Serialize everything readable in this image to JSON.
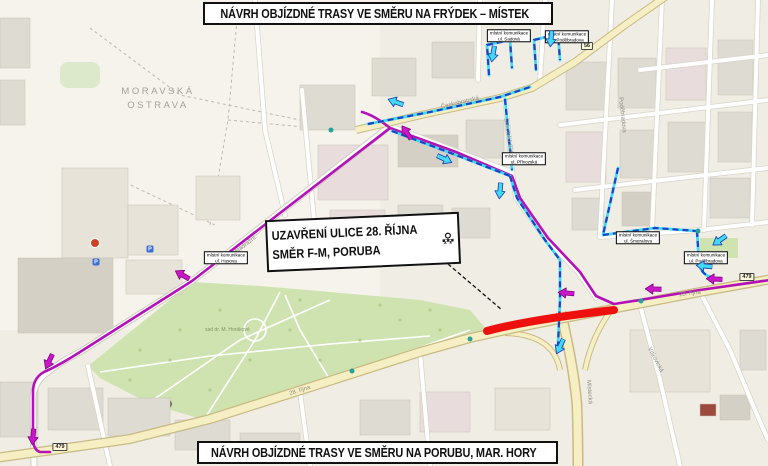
{
  "banners": {
    "top": {
      "text": "NÁVRH OBJÍZDNÉ TRASY VE SMĚRU NA FRÝDEK – MÍSTEK",
      "arrow_icon": "arrow-right-icon",
      "arrow_color": "#41d9f6"
    },
    "bottom": {
      "text": "NÁVRH OBJÍZDNÉ TRASY VE SMĚRU NA PORUBU, MAR. HORY",
      "arrow_icon": "arrow-right-icon",
      "arrow_color": "#cb16cb"
    }
  },
  "closure_callout": {
    "line1": "UZAVŘENÍ ULICE 28. ŘÍJNA",
    "line2": "SMĚR F-M, PORUBA",
    "icon": "road-closure-icon"
  },
  "colors": {
    "closure_red": "#ee100f",
    "detour_frydek_fill": "#41d9f6",
    "detour_frydek_dash": "#1d42c4",
    "detour_poruba": "#b312b6",
    "park_green": "#cfe3b0",
    "arrow_cyan": "#41d9f6",
    "arrow_cyan_edge": "#1b3fae",
    "arrow_magenta": "#cb16cb",
    "arrow_magenta_edge": "#7c0a7c"
  },
  "map": {
    "district_label_line1": "MORAVSKÁ",
    "district_label_line2": "OSTRAVA",
    "park_label": "sad dr. M. Horákové",
    "street_labels": [
      {
        "text": "Českobratrská",
        "x": 460,
        "y": 103,
        "rot": -13
      },
      {
        "text": "28. října",
        "x": 300,
        "y": 391,
        "rot": -18
      },
      {
        "text": "28. října",
        "x": 690,
        "y": 294,
        "rot": -7
      },
      {
        "text": "Nádražní",
        "x": 246,
        "y": 245,
        "rot": -38
      },
      {
        "text": "Místecká",
        "x": 589,
        "y": 392,
        "rot": 86
      },
      {
        "text": "Sokolská třída",
        "x": 508,
        "y": 137,
        "rot": 82
      },
      {
        "text": "Poděbradova",
        "x": 622,
        "y": 115,
        "rot": 84
      },
      {
        "text": "Vítkovická",
        "x": 655,
        "y": 360,
        "rot": 62
      }
    ],
    "road_badges": [
      {
        "text": "479",
        "x": 60,
        "y": 447
      },
      {
        "text": "479",
        "x": 747,
        "y": 277
      },
      {
        "text": "56",
        "x": 587,
        "y": 46
      }
    ],
    "local_road_labels": [
      {
        "line1": "místní komunikace",
        "line2": "ul. Sadová",
        "x": 509,
        "y": 36
      },
      {
        "line1": "místní komunikace",
        "line2": "ul. Poděbradova",
        "x": 567,
        "y": 37
      },
      {
        "line1": "místní komunikace",
        "line2": "ul. Přívozská",
        "x": 524,
        "y": 159
      },
      {
        "line1": "místní komunikace",
        "line2": "ul. Šmeralova",
        "x": 638,
        "y": 238
      },
      {
        "line1": "místní komunikace",
        "line2": "ul. Poděbradova",
        "x": 706,
        "y": 258
      },
      {
        "line1": "místní komunikace",
        "line2": "ul. Husova",
        "x": 226,
        "y": 258
      }
    ],
    "poi": [
      {
        "type": "parking",
        "x": 150,
        "y": 249
      },
      {
        "type": "parking",
        "x": 96,
        "y": 262
      },
      {
        "type": "stop",
        "x": 352,
        "y": 371
      },
      {
        "type": "stop",
        "x": 470,
        "y": 339
      },
      {
        "type": "stop",
        "x": 641,
        "y": 301
      },
      {
        "type": "stop",
        "x": 331,
        "y": 130
      },
      {
        "type": "stop",
        "x": 698,
        "y": 231
      },
      {
        "type": "red",
        "x": 95,
        "y": 243
      }
    ]
  },
  "route_arrows": [
    {
      "color": "cyan",
      "x": 396,
      "y": 100,
      "rot": 200
    },
    {
      "color": "cyan",
      "x": 444,
      "y": 161,
      "rot": 25
    },
    {
      "color": "cyan",
      "x": 498,
      "y": 191,
      "rot": 95
    },
    {
      "color": "cyan",
      "x": 491,
      "y": 54,
      "rot": 100
    },
    {
      "color": "cyan",
      "x": 549,
      "y": 39,
      "rot": 95
    },
    {
      "color": "cyan",
      "x": 718,
      "y": 239,
      "rot": 145
    },
    {
      "color": "cyan",
      "x": 704,
      "y": 264,
      "rot": 185
    },
    {
      "color": "cyan",
      "x": 558,
      "y": 346,
      "rot": 115
    },
    {
      "color": "magenta",
      "x": 408,
      "y": 131,
      "rot": -125
    },
    {
      "color": "magenta",
      "x": 183,
      "y": 273,
      "rot": 210
    },
    {
      "color": "magenta",
      "x": 47,
      "y": 361,
      "rot": 115
    },
    {
      "color": "magenta",
      "x": 31,
      "y": 437,
      "rot": 95
    },
    {
      "color": "magenta",
      "x": 566,
      "y": 291,
      "rot": 185
    },
    {
      "color": "magenta",
      "x": 653,
      "y": 287,
      "rot": 182
    },
    {
      "color": "magenta",
      "x": 714,
      "y": 277,
      "rot": 183
    }
  ]
}
